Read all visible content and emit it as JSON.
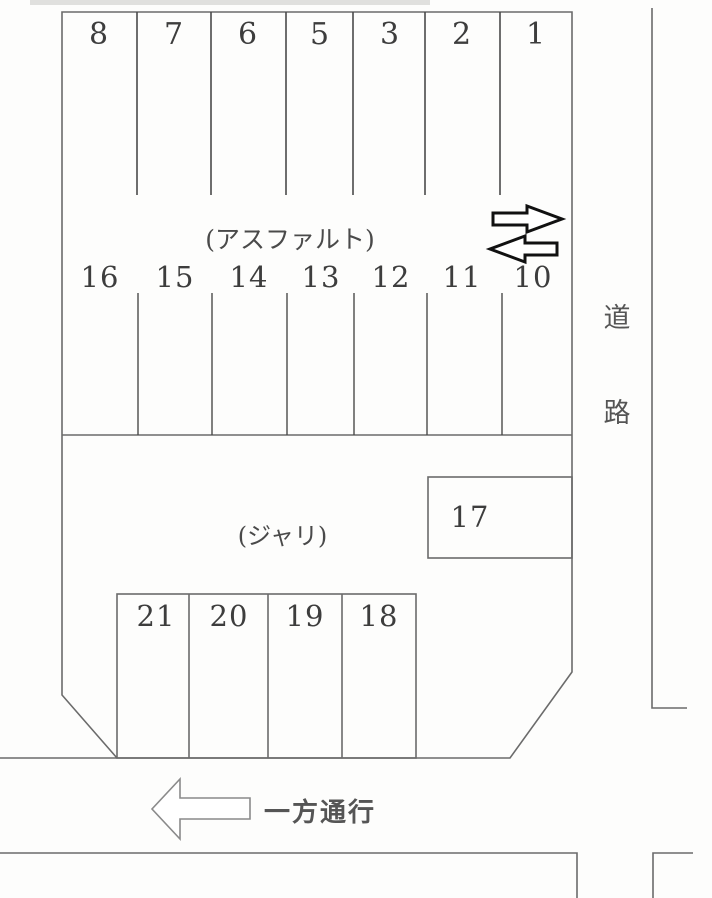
{
  "diagram": {
    "kind": "parking-lot-layout",
    "colors": {
      "line": "#6b6b6b",
      "divider": "#4a4a4a",
      "text": "#3d3d3d",
      "arrow_outline_black": "#111111",
      "arrow_outline_gray": "#8a8a8a"
    },
    "lot": {
      "surface_top_label": "(アスファルト)",
      "surface_bottom_label": "(ジャリ)",
      "row_top": [
        "8",
        "7",
        "6",
        "5",
        "3",
        "2",
        "1"
      ],
      "row_middle": [
        "16",
        "15",
        "14",
        "13",
        "12",
        "11",
        "10"
      ],
      "stall_17": "17",
      "row_bottom": [
        "21",
        "20",
        "19",
        "18"
      ]
    },
    "road": {
      "chars": [
        "道",
        "路"
      ]
    },
    "one_way": {
      "label": "一方通行"
    },
    "icons": [
      "arrow-right",
      "arrow-left",
      "arrow-left-oneway"
    ]
  }
}
